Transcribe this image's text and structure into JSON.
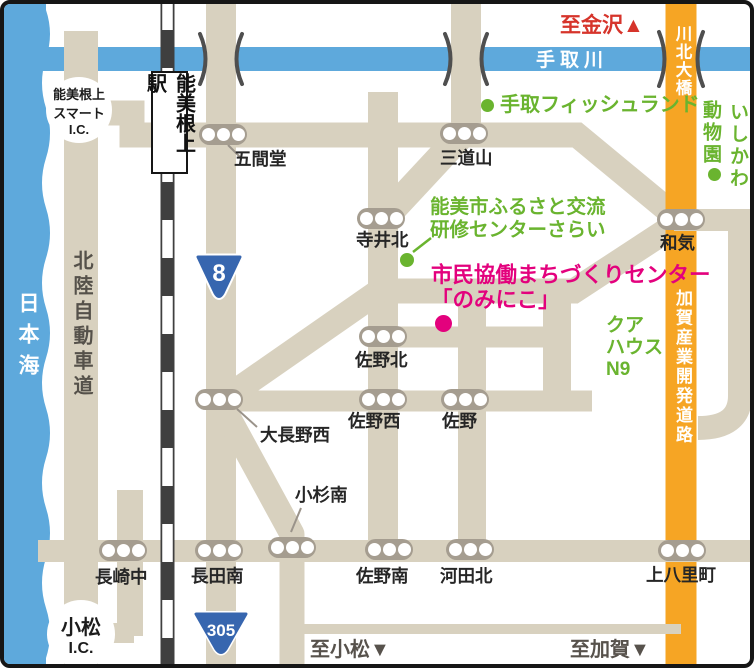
{
  "map": {
    "geo_labels": {
      "sea": "日本海",
      "river": "手取川",
      "expressway": "北陸自動車道",
      "station": "能美根上駅",
      "bridge": "川北大橋",
      "kaga_road": "加賀産業開発道路",
      "smart_ic": {
        "line1": "能美根上",
        "line2": "スマート",
        "line3": "I.C."
      },
      "komatsu_ic": {
        "line1": "小松",
        "line2": "I.C."
      }
    },
    "directions": {
      "kanazawa": "至金沢▲",
      "komatsu": "至小松▼",
      "kaga": "至加賀▼"
    },
    "route_badges": {
      "route8": "8",
      "route305": "305"
    },
    "intersections": [
      {
        "label": "五間堂"
      },
      {
        "label": "三道山"
      },
      {
        "label": "寺井北"
      },
      {
        "label": "和気"
      },
      {
        "label": "佐野北"
      },
      {
        "label": "大長野西"
      },
      {
        "label": "佐野西"
      },
      {
        "label": "佐野"
      },
      {
        "label": "小杉南"
      },
      {
        "label": "長崎中"
      },
      {
        "label": "長田南"
      },
      {
        "label": "佐野南"
      },
      {
        "label": "河田北"
      },
      {
        "label": "上八里町"
      }
    ],
    "pois": {
      "fishland": "手取フィッシュランド",
      "zoo_right_column": "いしかわ",
      "zoo_left_column": "動物園",
      "sarai_line1": "能美市ふるさと交流",
      "sarai_line2": "研修センターさらい",
      "center_line1": "市民協働まちづくりセンター",
      "center_line2": "「のみにこ」",
      "kurhaus_line1": "クア",
      "kurhaus_line2": "ハウス",
      "kurhaus_line3": "N9"
    },
    "colors": {
      "road": "#d8d1bf",
      "water": "#5ea9dc",
      "orange_road": "#f6a524",
      "green_poi": "#6ab42f",
      "magenta_poi": "#e3017d",
      "red_direction": "#d6342b",
      "rail_dark": "#4a4a4a",
      "signal_gray": "#a59d90"
    }
  }
}
